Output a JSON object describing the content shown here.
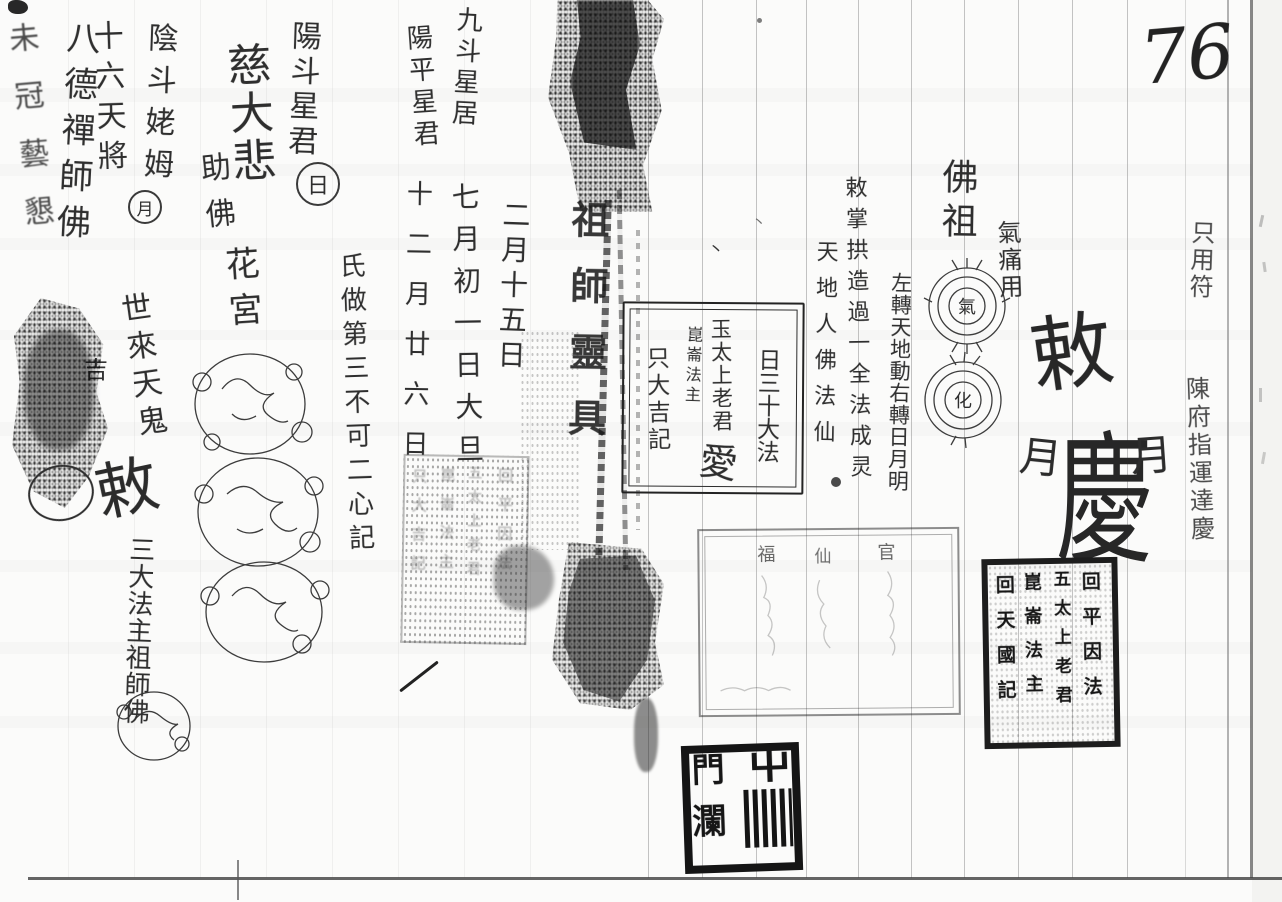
{
  "page_number": "76",
  "left_page": {
    "deity_columns": [
      "九斗星居",
      "陽平星君",
      "陽斗星君",
      "慈大悲",
      "助佛",
      "陰斗姥姆",
      "十六天將",
      "八德禪師佛",
      "未冠藝懇"
    ],
    "circled_day": "日",
    "circled_moon": "月",
    "date_columns": [
      "二月十五日",
      "七月初一日大旦",
      "十二月廿六日"
    ],
    "note_column": "氏做第三不可二心記",
    "master_column": "祖師靈具",
    "flower_column": "花宮",
    "luck_char": "吉",
    "spirit_column": "世來天鬼",
    "edict_char": "敕",
    "dharma_column": "三大法主祖師佛"
  },
  "center_box": {
    "col1": "日三十大法",
    "col2": "玉太上老君",
    "col2_big": "愛",
    "col3": "崑崙法主",
    "col4": "只大吉記"
  },
  "faint_seal": {
    "col1": "回平因法",
    "col2": "五太上老君",
    "col3": "崑崙法主",
    "col4": "只大吉記"
  },
  "right_page": {
    "buddha_column": "佛祖",
    "qi_circle_char": "氣",
    "hua_circle_char": "化",
    "qi_use_column": "氣痛用",
    "chant_columns": [
      "左轉天地動右轉日月明",
      "敕掌拱造過一全法成灵",
      "天地人佛法仙"
    ],
    "talisman": {
      "top": "敕",
      "left": "月",
      "center": "慶",
      "right": "月"
    },
    "edge_column_1": "只用符",
    "edge_column_2": "陳府指運達慶",
    "faint_stamp_chars": [
      "福",
      "仙",
      "官"
    ],
    "dark_seal": {
      "col1": "回平因法",
      "col2": "五太上老君",
      "col3": "崑崙法主",
      "col4": "回天國記"
    },
    "black_seal": {
      "top_right": "屮",
      "top_left": "門",
      "bottom_left": "瀾"
    },
    "tick_mark": "丶"
  }
}
